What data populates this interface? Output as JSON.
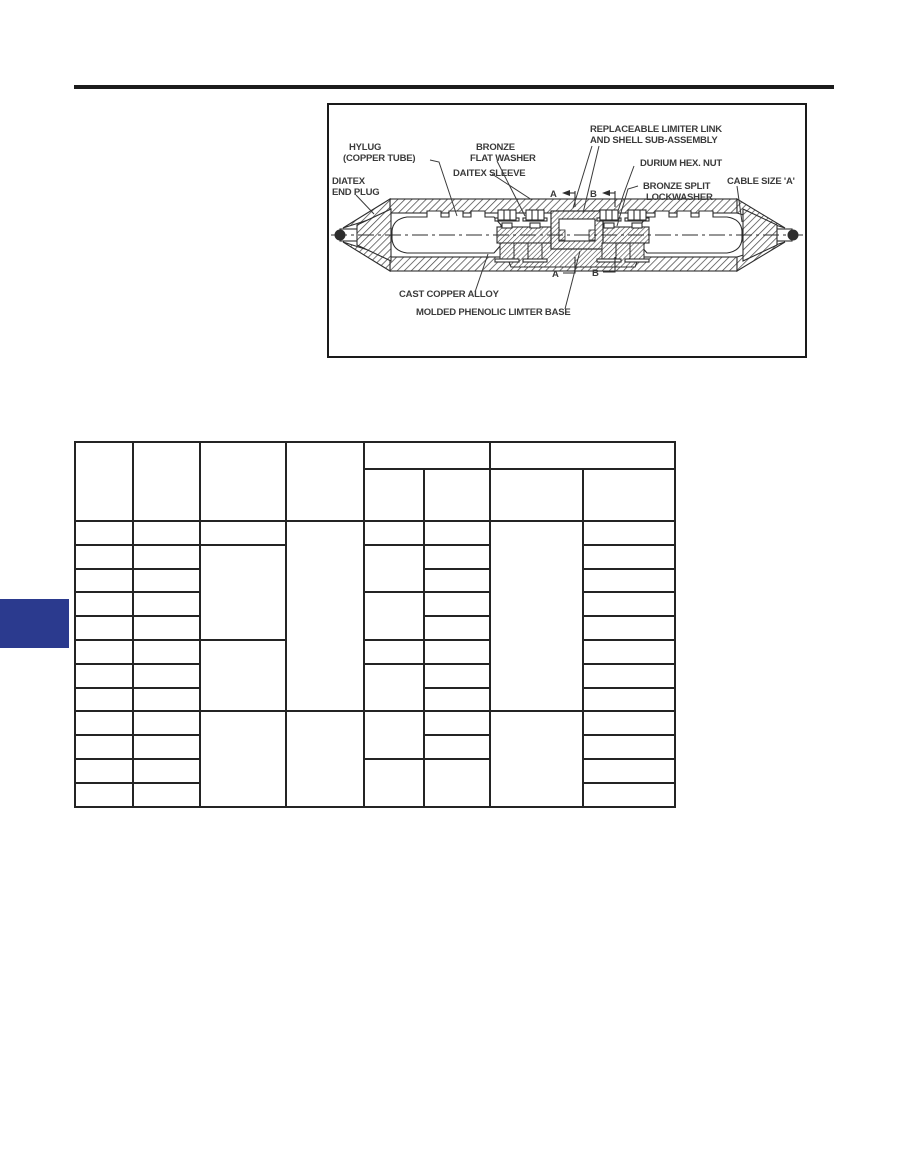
{
  "colors": {
    "accent_block": "#2b3a8e",
    "top_rule": "#1c1c1c",
    "table_border": "#242424",
    "drawing_line": "#2d2d2d",
    "label_text": "#3b3b3b"
  },
  "diagram": {
    "labels": {
      "hylug_line1": "HYLUG",
      "hylug_line2": "(COPPER TUBE)",
      "end_plug_line1": "DIATEX",
      "end_plug_line2": "END PLUG",
      "flat_washer_line1": "BRONZE",
      "flat_washer_line2": "FLAT WASHER",
      "sleeve": "DAITEX SLEEVE",
      "limiter_link_line1": "REPLACEABLE LIMITER LINK",
      "limiter_link_line2": "AND SHELL SUB-ASSEMBLY",
      "hex_nut": "DURIUM HEX. NUT",
      "lockwasher_line1": "BRONZE SPLIT",
      "lockwasher_line2": "LOCKWASHER",
      "cable_size": "CABLE SIZE 'A'",
      "cast_copper": "CAST COPPER ALLOY",
      "phenolic_base": "MOLDED PHENOLIC LIMTER BASE",
      "section_a": "A",
      "section_b": "B"
    }
  }
}
